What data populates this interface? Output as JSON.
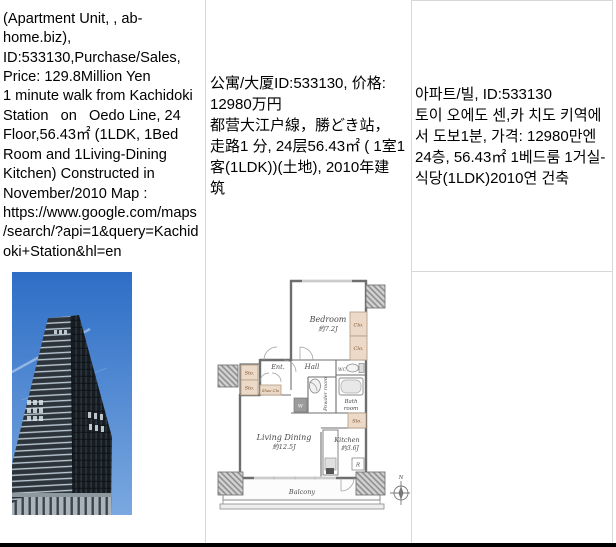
{
  "listing": {
    "description_en": "(Apartment Unit, , ab-\nhome.biz),\nID:533130,Purchase/Sales,\nPrice: 129.8Million Yen\n1 minute walk from Kachidoki\nStation   on   Oedo Line, 24\nFloor,56.43㎡ (1LDK, 1Bed\nRoom and 1Living-Dining\nKitchen) Constructed in\nNovember/2010 Map :\nhttps://www.google.com/maps\n/search/?api=1&query=Kachid\noki+Station&hl=en",
    "description_zh": "公寓/大厦ID:533130, 价格:\n12980万円\n都营大江户線，勝どき站，\n走路1 分, 24层56.43㎡ ( 1室1\n客(1LDK))(土地), 2010年建\n筑",
    "description_ko": "아파트/빌, ID:533130\n토이 오에도 센,카 치도 키역에\n서 도보1분, 가격: 12980만엔\n24층, 56.43㎡ 1베드룸 1거실-\n식당(1LDK)2010연 건축"
  },
  "floorplan": {
    "labels": {
      "bedroom": "Bedroom",
      "bedroom_size": "約7.2J",
      "living": "Living Dining",
      "living_size": "約12.5J",
      "kitchen": "Kitchen",
      "kitchen_size": "約3.6J",
      "hall": "Hall",
      "entrance": "Ent.",
      "balcony": "Balcony",
      "bath_line1": "Bath",
      "bath_line2": "room",
      "powder": "Powder room",
      "wc": "WC",
      "closet": "Clo.",
      "storage": "Sto.",
      "shoe_closet": "Shoe Clo",
      "washer": "W",
      "fridge": "R",
      "north": "N"
    }
  },
  "colors": {
    "cell_border": "#d8d8d8",
    "bottom_bar": "#000000",
    "sky_top": "#2e6ec6",
    "sky_bottom": "#7aa8e0",
    "closet_fill": "#ecd9c7",
    "wall": "#6e6e6e"
  }
}
